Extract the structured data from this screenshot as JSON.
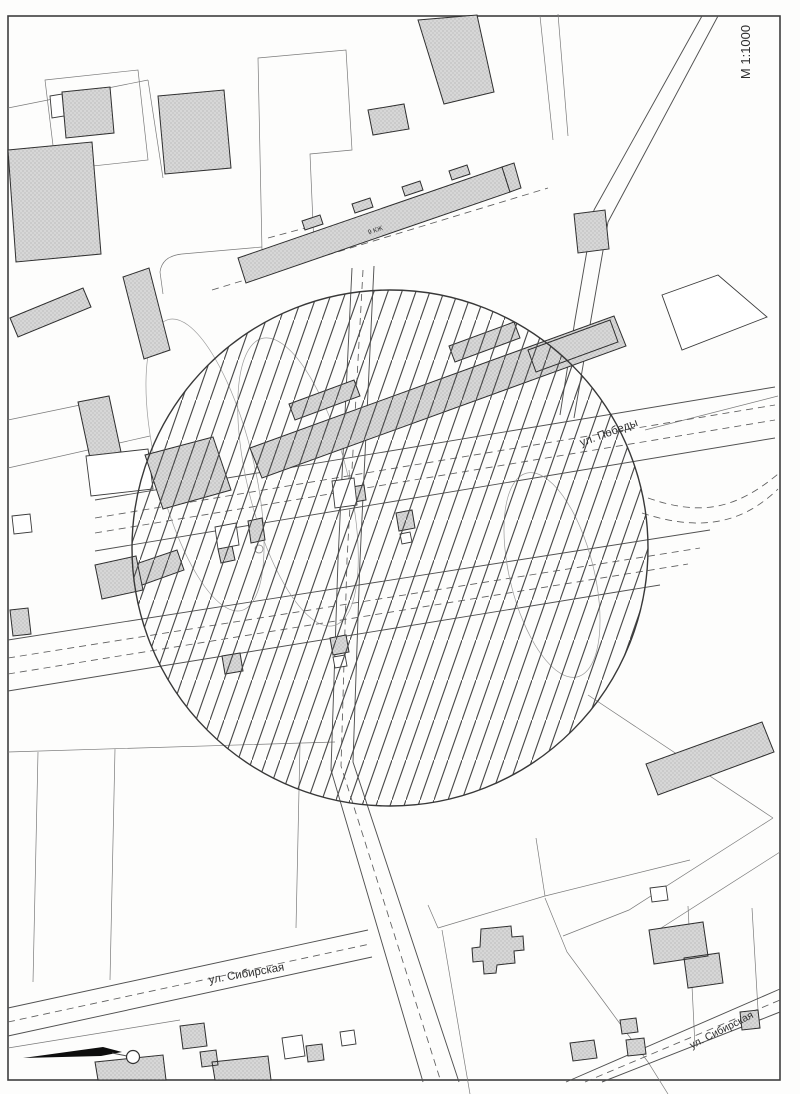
{
  "map": {
    "scale_label": "М 1:1000",
    "streets": {
      "pobedy_label": "ул. Победы",
      "sibirskaya_west_label": "ул. Сибирская",
      "sibirskaya_east_label": "ул. Сибирская"
    },
    "buildings": {
      "apartment_block_label": "9 КЖ"
    },
    "colors": {
      "paper": "#fdfdfc",
      "linework": "#515151",
      "building_fill": "#d6d6d6",
      "building_stroke": "#2f2f2f",
      "hatch_line": "#4a4a4a",
      "circle_stroke": "#383838",
      "arrow_fill": "#0d0d0d"
    }
  }
}
